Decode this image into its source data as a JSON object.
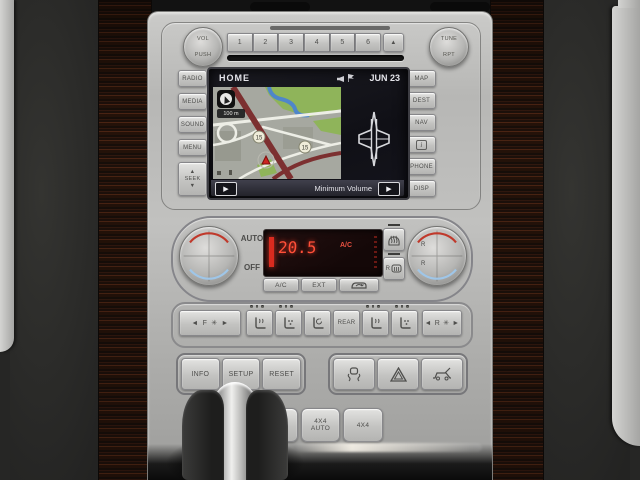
{
  "radio": {
    "volume_knob_top": "VOL",
    "volume_knob_bottom": "PUSH",
    "tune_knob_top": "TUNE",
    "tune_knob_bottom": "RPT",
    "presets": [
      "1",
      "2",
      "3",
      "4",
      "5",
      "6"
    ]
  },
  "icons": {
    "eject": "▲",
    "seek_up": "▲",
    "seek_down": "▼",
    "softkey_play": "▶",
    "arrow_left": "◄",
    "arrow_right": "►",
    "fan": "✳"
  },
  "menu_left": {
    "items": [
      "RADIO",
      "MEDIA",
      "SOUND",
      "MENU"
    ],
    "seek_label": "SEEK"
  },
  "menu_right": {
    "items": [
      "MAP",
      "DEST",
      "NAV",
      "i",
      "PHONE",
      "DISP"
    ]
  },
  "screen": {
    "title": "HOME",
    "date": "JUN 23",
    "status_bar_text": "Minimum Volume",
    "map": {
      "scale": "100 m",
      "shield_a": "15",
      "shield_b": "15"
    }
  },
  "climate": {
    "auto_label": "AUTO",
    "off_label": "OFF",
    "display": {
      "temperature": "20.5",
      "ac_indicator": "A/C"
    },
    "ac_label": "A/C",
    "ext_label": "EXT",
    "rear_defrost_label": "R",
    "right_knob_label_top": "R",
    "right_knob_label_bottom": "R"
  },
  "comfort": {
    "front_zone": "F",
    "rear_zone": "R",
    "rear_button": "REAR"
  },
  "system": {
    "info_label": "INFO",
    "setup_label": "SETUP",
    "reset_label": "RESET"
  },
  "drivetrain": {
    "mode_4x2": "4X2",
    "mode_4x4auto_line1": "4X4",
    "mode_4x4auto_line2": "AUTO",
    "mode_4x4": "4X4"
  },
  "colors": {
    "display_red": "#ff4f38",
    "map_green": "#8fb45a",
    "map_water": "#4f86c9",
    "road_maroon": "#7c3030"
  }
}
